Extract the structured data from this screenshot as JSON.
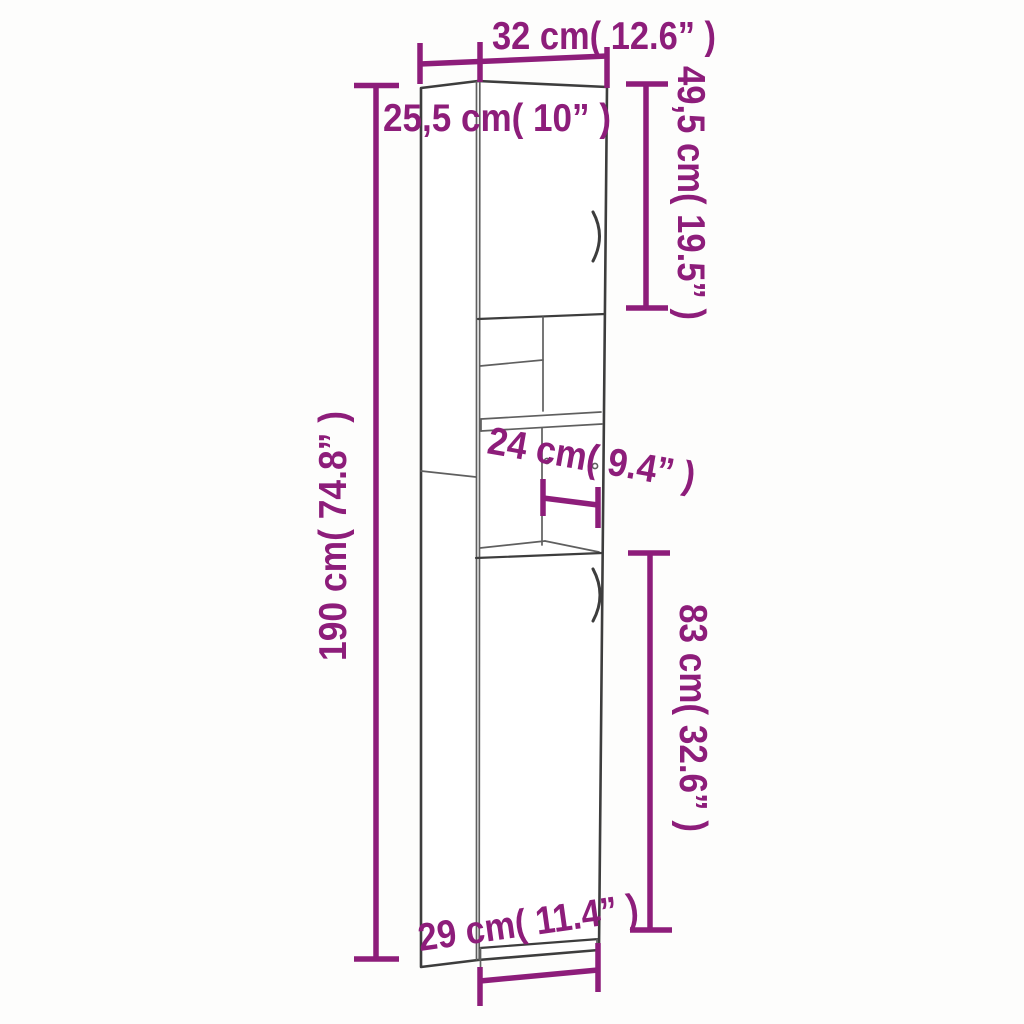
{
  "colors": {
    "dimension": "#8D1D7A",
    "outline": "#3d3d3d",
    "detail": "#5f5f5f",
    "background": "#fdfdfc"
  },
  "diagram": {
    "subject": "tall-cabinet-dimension-drawing",
    "dimensions": {
      "top_width": "32 cm( 12.6” )",
      "top_depth": "25,5 cm( 10” )",
      "upper_door_height": "49,5 cm( 19.5” )",
      "total_height": "190 cm( 74.8” )",
      "shelf_depth": "24 cm( 9.4” )",
      "lower_door_height": "83 cm( 32.6” )",
      "bottom_width": "29 cm( 11.4” )"
    }
  }
}
